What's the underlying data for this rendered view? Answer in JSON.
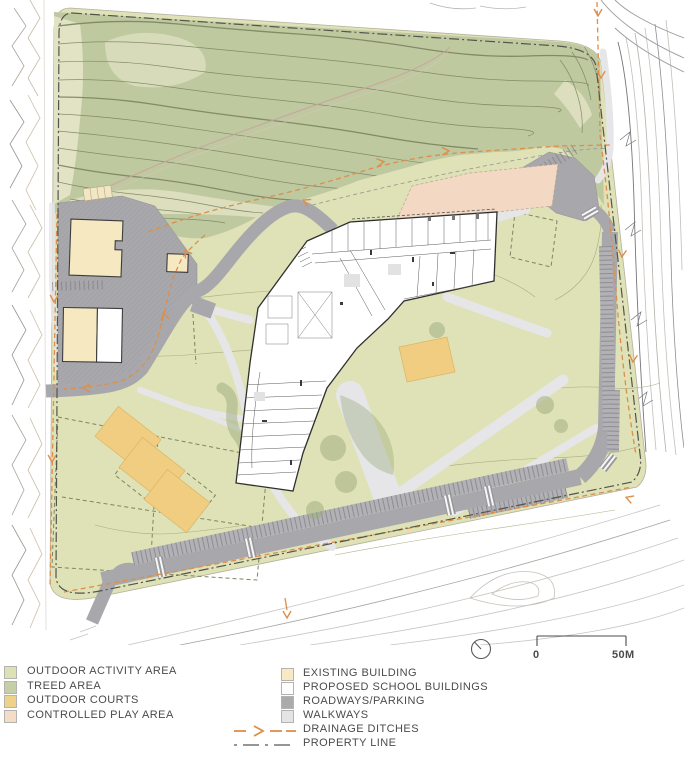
{
  "legend": {
    "left_items": [
      {
        "label": "OUTDOOR ACTIVITY AREA",
        "color": "#dde1b4"
      },
      {
        "label": "TREED AREA",
        "color": "#c4cfa5"
      },
      {
        "label": "OUTDOOR COURTS",
        "color": "#efd28a"
      },
      {
        "label": "CONTROLLED PLAY AREA",
        "color": "#f5dcc6"
      }
    ],
    "right_items": [
      {
        "label": "EXISTING BUILDING",
        "color": "#f7e9c3"
      },
      {
        "label": "PROPOSED SCHOOL BUILDINGS",
        "color": "#ffffff"
      },
      {
        "label": "ROADWAYS/PARKING",
        "color": "#ababaf"
      },
      {
        "label": "WALKWAYS",
        "color": "#e4e4e6"
      }
    ],
    "line_items": [
      {
        "label": "DRAINAGE DITCHES",
        "symbol": "drainage-arrow-icon",
        "color": "#dd8e49"
      },
      {
        "label": "PROPERTY LINE",
        "symbol": "dash-dot-line-icon",
        "color": "#8a8a86"
      }
    ]
  },
  "scale_bar": {
    "start_label": "0",
    "end_label": "50M"
  },
  "north_arrow": "north-indicator",
  "colors": {
    "outdoor_activity_area": "#dfe1b6",
    "treed_area": "#bfc9a0",
    "outdoor_courts": "#f0cd80",
    "controlled_play_area": "#f3d8c4",
    "existing_building": "#f6e9c2",
    "proposed_building": "#ffffff",
    "roadways_parking": "#a8a8ac",
    "walkways": "#e6e6e8",
    "drainage": "#dd8e49",
    "property_line": "#53544e"
  },
  "map_features": [
    "treed-area-with-contours",
    "outdoor-activity-fields",
    "proposed-school-building",
    "existing-building-compound",
    "outdoor-courts",
    "controlled-play-area",
    "perimeter-parking-roadways",
    "walkway-network",
    "drainage-ditches",
    "property-line",
    "offsite-contour-lines"
  ]
}
